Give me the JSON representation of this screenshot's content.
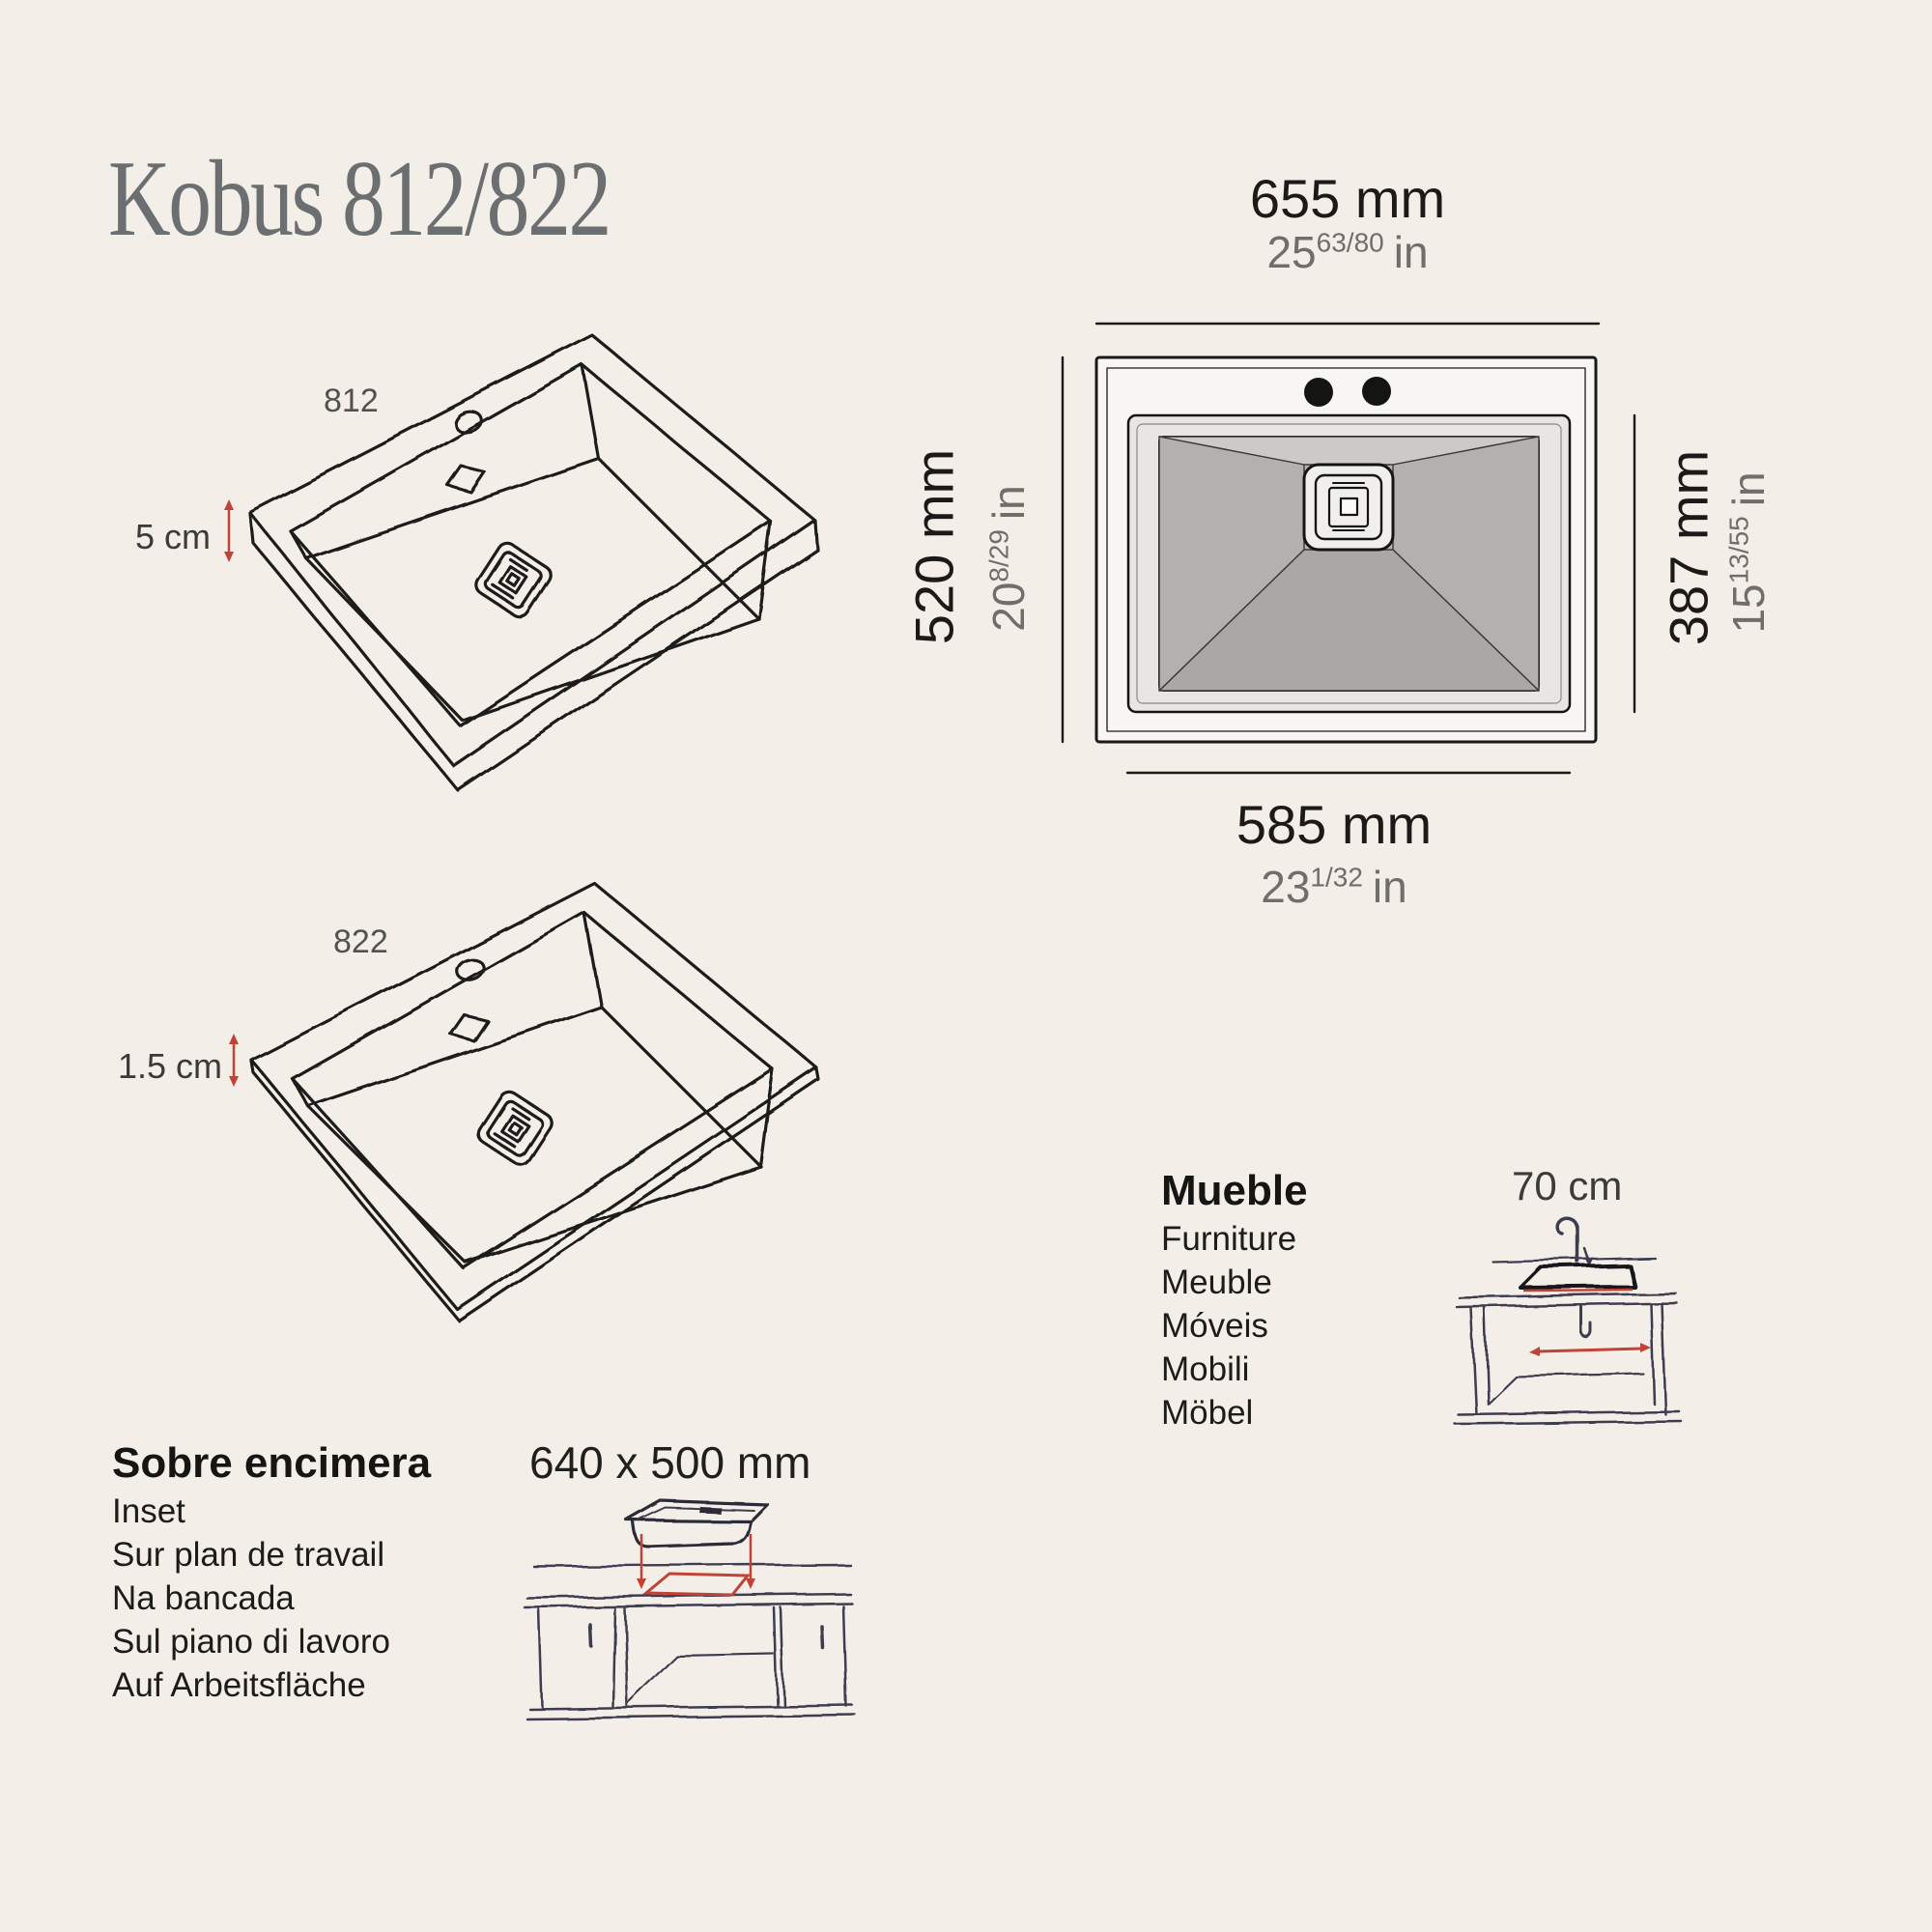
{
  "page": {
    "title": "Kobus 812/822"
  },
  "colors": {
    "background": "#f3eee7",
    "ink": "#1b1a18",
    "gray_text": "#6f6e6b",
    "title_gray": "#6c6f71",
    "accent_red": "#bf4437",
    "cabinet_ink": "#3e3c50",
    "basin_gray": "#b7b6b3",
    "rim_gray": "#e7e6e3"
  },
  "top_view": {
    "top": {
      "mm": "655 mm",
      "in_int": "25",
      "in_frac": "63/80",
      "in_unit": "in"
    },
    "left": {
      "mm": "520 mm",
      "in_int": "20",
      "in_frac": "8/29",
      "in_unit": "in"
    },
    "right": {
      "mm": "387 mm",
      "in_int": "15",
      "in_frac": "13/55",
      "in_unit": "in"
    },
    "bottom": {
      "mm": "585 mm",
      "in_int": "23",
      "in_frac": "1/32",
      "in_unit": "in"
    }
  },
  "models": {
    "m812": {
      "label": "812",
      "edge_height": "5 cm"
    },
    "m822": {
      "label": "822",
      "edge_height": "1.5 cm"
    }
  },
  "inset_block": {
    "heading": "Sobre encimera",
    "items": [
      "Inset",
      "Sur plan de travail",
      "Na bancada",
      "Sul piano di lavoro",
      "Auf Arbeitsfläche"
    ],
    "cutout": "640 x 500 mm"
  },
  "furniture_block": {
    "heading": "Mueble",
    "items": [
      "Furniture",
      "Meuble",
      "Móveis",
      "Mobili",
      "Möbel"
    ],
    "min_width": "70 cm"
  }
}
